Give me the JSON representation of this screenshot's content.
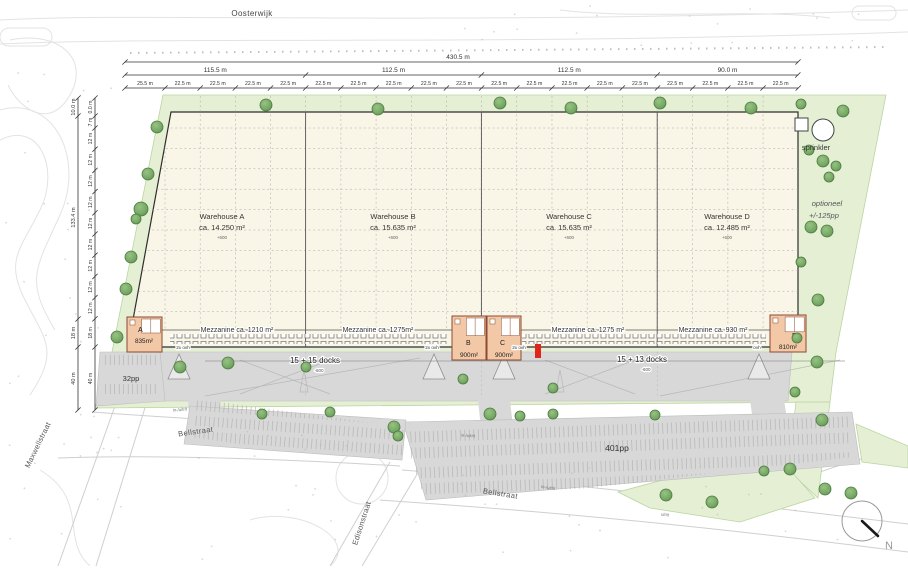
{
  "palette": {
    "green_area": "#e4efd4",
    "green_edge": "#bcd4a2",
    "tree_fill": "#74a763",
    "tree_edge": "#4d7a40",
    "building_fill": "#f9f5e7",
    "building_edge": "#2e2e2e",
    "grid_line": "#a8a8a8",
    "office_fill": "#f2c8a6",
    "office_edge": "#8a4a32",
    "paving": "#d8d8d8",
    "road_edge": "#c9c9c9",
    "dim_color": "#333333",
    "marker_red": "#e2251b"
  },
  "streets": {
    "oosterwijk": "Oosterwijk",
    "maxwellstraat": "Maxwellstraat",
    "bellstraat_upper": "Bellstraat",
    "bellstraat_lower": "Bellstraat",
    "edisonstraat": "Edisonstraat"
  },
  "dimensions_top": {
    "total": "430.5 m",
    "sections": [
      "115.5 m",
      "112.5 m",
      "112.5 m",
      "90.0 m"
    ],
    "bays": [
      "25.5 m",
      "22.5 m",
      "22.5 m",
      "22.5 m",
      "22.5 m",
      "22.5 m",
      "22.5 m",
      "22.5 m",
      "22.5 m",
      "22.5 m",
      "22.5 m",
      "22.5 m",
      "22.5 m",
      "22.5 m",
      "22.5 m",
      "22.5 m",
      "22.5 m",
      "22.5 m",
      "22.5 m"
    ]
  },
  "dimensions_left": {
    "outer": [
      "10.0 m",
      "133.4 m",
      "18 m",
      "40 m"
    ],
    "inner": [
      "0.0 m",
      "7 m",
      "12 m",
      "12 m",
      "12 m",
      "12 m",
      "12 m",
      "12 m",
      "12 m",
      "12 m",
      "12 m",
      "18 m",
      "40 m"
    ]
  },
  "warehouses": [
    {
      "name": "Warehouse A",
      "area": "ca. 14.250 m²",
      "level": "+600",
      "mezzanine": "Mezzanine ca. 1210 m²",
      "office_label": "A",
      "office_area": "835m²"
    },
    {
      "name": "Warehouse B",
      "area": "ca. 15.635 m²",
      "level": "+600",
      "mezzanine": "Mezzanine ca. 1275m²",
      "office_label": "B",
      "office_area": "900m²"
    },
    {
      "name": "Warehouse C",
      "area": "ca. 15.635 m²",
      "level": "+600",
      "mezzanine": "Mezzanine ca. 1275 m²",
      "office_label": "C",
      "office_area": "900m²"
    },
    {
      "name": "Warehouse D",
      "area": "ca. 12.485 m²",
      "level": "+600",
      "mezzanine": "Mezzanine ca. 930 m²",
      "office_label": "D",
      "office_area": "810m²"
    }
  ],
  "docks": [
    {
      "label": "15 + 15 docks",
      "level": "-600"
    },
    {
      "label": "15 + 13 docks",
      "level": "-600"
    }
  ],
  "door_labels": [
    "2x ovh",
    "2x ovh",
    "2x ovh",
    "ovh"
  ],
  "parking": {
    "west": "32pp",
    "main": "401pp",
    "optional_line1": "optioneel",
    "optional_line2": "+/-125pp"
  },
  "legend": {
    "sprinkler": "sprinkler"
  },
  "access_labels": [
    "in-/uitrit",
    "in-/uitrit",
    "in-/uitrit",
    "uitrit"
  ],
  "compass": {
    "north": "N"
  }
}
